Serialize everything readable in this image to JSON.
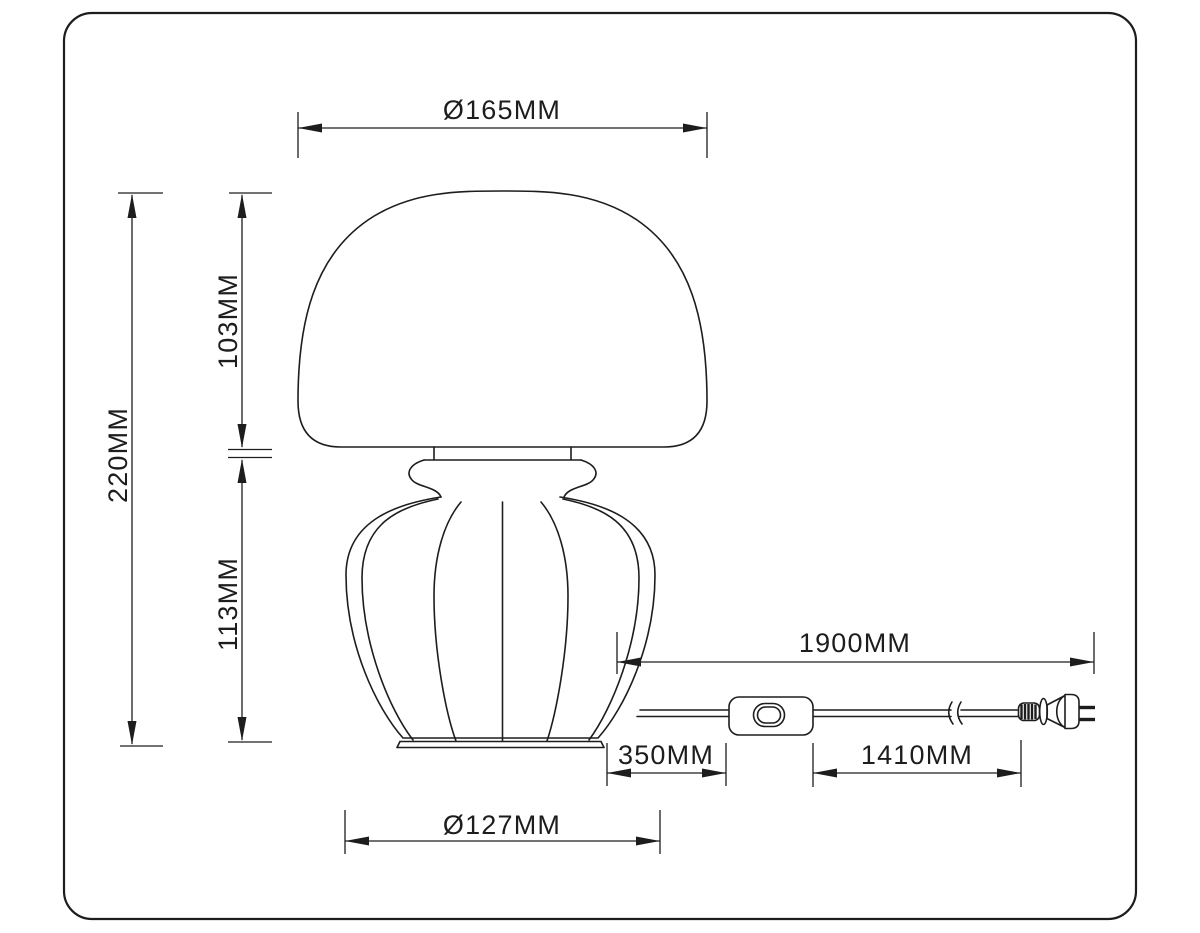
{
  "diagram": {
    "type": "technical-dimension-drawing",
    "subject": "mushroom-dome table lamp with inline switch power cord and two-prong plug",
    "dimensions": {
      "shade_diameter": "Ø165MM",
      "total_height": "220MM",
      "shade_height": "103MM",
      "base_height": "113MM",
      "base_diameter": "Ø127MM",
      "cord_total": "1900MM",
      "cord_lamp_to_switch": "350MM",
      "cord_switch_to_plug": "1410MM"
    },
    "colors": {
      "line": "#1d1d1d",
      "background": "#ffffff"
    }
  }
}
